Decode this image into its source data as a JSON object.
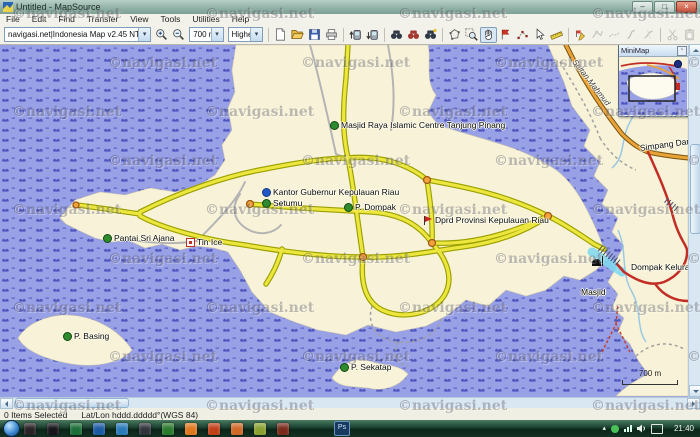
{
  "window": {
    "title": "Untitled - MapSource",
    "controls": [
      "minimize",
      "maximize",
      "close"
    ]
  },
  "menu": {
    "items": [
      "File",
      "Edit",
      "Find",
      "Transfer",
      "View",
      "Tools",
      "Utilities",
      "Help"
    ]
  },
  "toolbar": {
    "product_selector": "navigasi.net|Indonesia Map v2.45 NT (free)",
    "scale_value": "700 m",
    "detail_value": "Highest",
    "icon_names": [
      "zoom-in",
      "zoom-out",
      "new-document",
      "open-file",
      "save",
      "print",
      "send-to-device",
      "receive-from-device",
      "find-places",
      "find-nearest-places",
      "recently-found-places",
      "map-tool",
      "zoom-tool",
      "hand-tool",
      "waypoint-tool",
      "route-tool",
      "selection-tool",
      "distance-bearing-tool",
      "edit-waypoint",
      "edit-route",
      "edit-track",
      "join-route",
      "divide-route",
      "cut",
      "paste"
    ]
  },
  "minimap": {
    "title": "MiniMap"
  },
  "map": {
    "scale_bar_label": "700 m",
    "watermark": "©navigasi.net",
    "watermark_grid": {
      "x0": 12,
      "y0": 6,
      "dx": 193,
      "dy": 49,
      "stagger": 96,
      "cols": 4,
      "rows": 9
    },
    "labels": [
      {
        "text": "Masjid Raya Islamic Centre Tanjung Pinang",
        "icon": "scenic",
        "x": 330,
        "y": 76
      },
      {
        "text": "Kantor Gubernur Kepulauan Riau",
        "icon": "info",
        "x": 262,
        "y": 143
      },
      {
        "text": "Setumu",
        "icon": "scenic",
        "x": 262,
        "y": 154
      },
      {
        "text": "P. Dompak",
        "icon": "scenic",
        "x": 344,
        "y": 158
      },
      {
        "text": "Dprd Provinsi Kepulauan Riau",
        "icon": "flag",
        "x": 424,
        "y": 171
      },
      {
        "text": "Dompak Kelurahan",
        "icon": "",
        "x": 631,
        "y": 218
      },
      {
        "text": "",
        "icon": "mosque",
        "x": 592,
        "y": 215
      },
      {
        "text": "Masjid",
        "icon": "",
        "x": 581,
        "y": 243
      },
      {
        "text": "Pantai Sri Ajana",
        "icon": "beach",
        "x": 103,
        "y": 189
      },
      {
        "text": "Tin Ice",
        "icon": "box",
        "x": 186,
        "y": 193
      },
      {
        "text": "P. Basing",
        "icon": "scenic",
        "x": 63,
        "y": 287
      },
      {
        "text": "P. Sekatap",
        "icon": "scenic",
        "x": 340,
        "y": 318
      },
      {
        "text": "Simpang Dang",
        "icon": "",
        "x": 640,
        "y": 99,
        "rot": -8
      },
      {
        "text": "Sultan Mahmud",
        "icon": "",
        "x": 574,
        "y": 12,
        "rot": 52,
        "cls": "roadname"
      }
    ],
    "colors": {
      "water": "#98a0e6",
      "water_pattern": "#5058c0",
      "land": "#f8f3d8",
      "road_major_yellow": "#ece63e",
      "road_highway_orange": "#eaa338",
      "road_red": "#c22d25",
      "road_minor_gray": "#b4b4b4",
      "roundabout": "#f2a33c"
    }
  },
  "status_bar": {
    "selection": "0 Items Selected",
    "position_format": "Lat/Lon hddd.ddddd°(WGS 84)"
  },
  "taskbar": {
    "clock": "21:40",
    "ps_badge": "Ps",
    "tray_icons": [
      "show-hidden-arrow",
      "antivirus",
      "network-signal",
      "volume",
      "keyboard-layout"
    ]
  }
}
